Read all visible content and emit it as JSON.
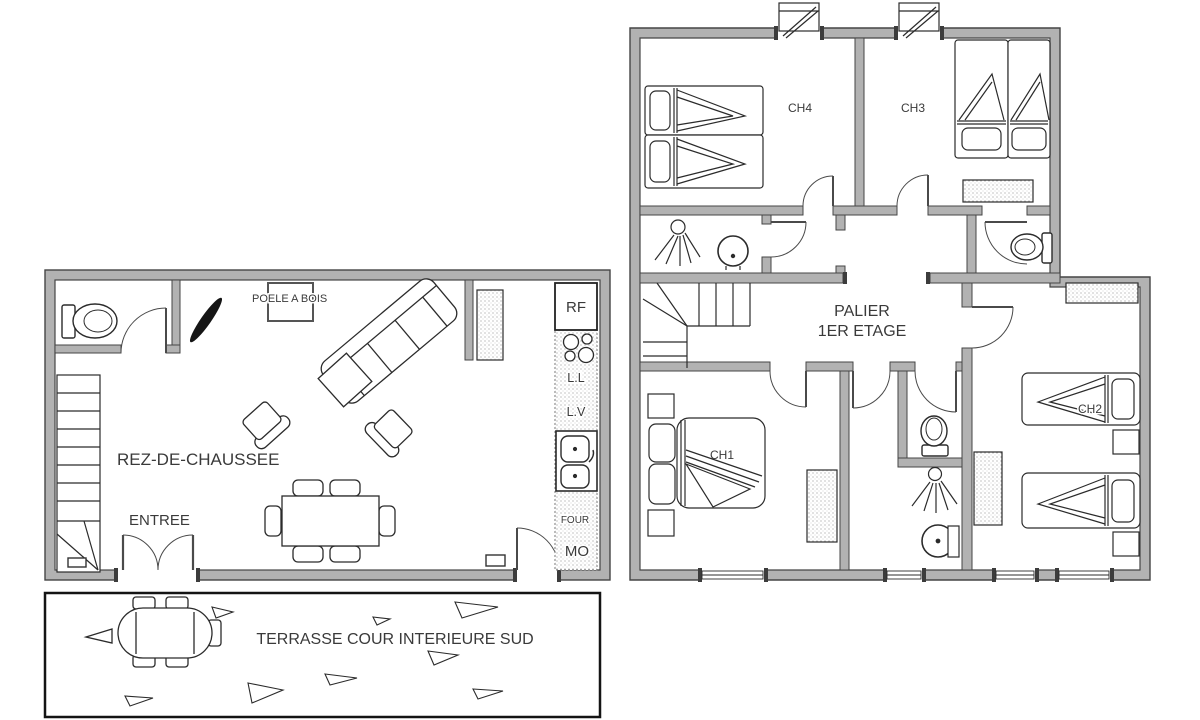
{
  "ground_floor": {
    "name": "REZ-DE-CHAUSSEE",
    "entrance": "ENTREE",
    "wood_stove": "POELE A BOIS",
    "appliances": {
      "fridge": "RF",
      "washing_machine": "L.L",
      "dishwasher": "L.V",
      "oven": "FOUR",
      "microwave": "MO"
    }
  },
  "first_floor": {
    "landing": [
      "PALIER",
      "1ER ETAGE"
    ],
    "bedroom_1": "CH1",
    "bedroom_2": "CH2",
    "bedroom_3": "CH3",
    "bedroom_4": "CH4"
  },
  "terrace": {
    "name": "TERRASSE COUR INTERIEURE SUD"
  },
  "colors": {
    "wall": "#b2b2b2",
    "wall_edge": "#454545",
    "line": "#2b2b2b",
    "background": "#ffffff"
  }
}
